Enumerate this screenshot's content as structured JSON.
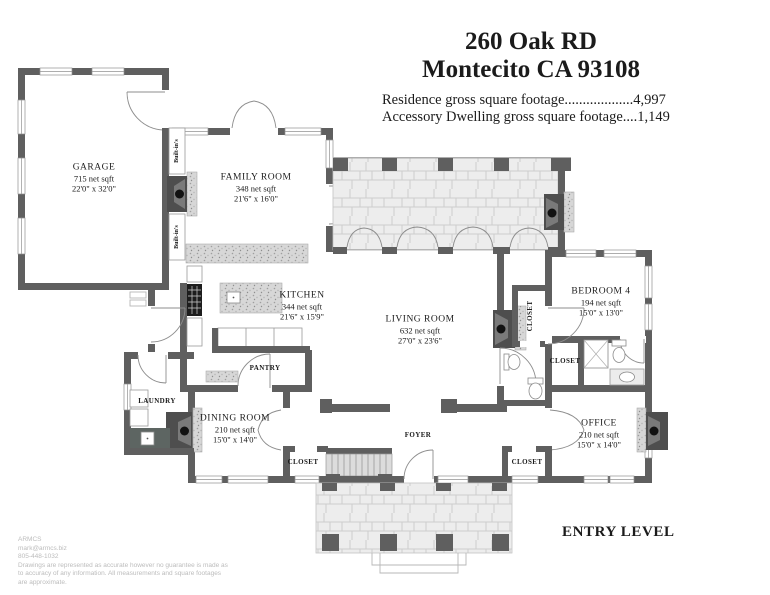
{
  "header": {
    "address_line1": "260 Oak RD",
    "address_line2": "Montecito CA 93108",
    "footage_line1": "Residence gross square footage...................4,997",
    "footage_line2": "Accessory Dwelling gross square footage....1,149"
  },
  "rooms": {
    "garage": {
      "name": "GARAGE",
      "sqft": "715 net sqft",
      "dims": "22'0\" x 32'0\""
    },
    "family_room": {
      "name": "FAMILY ROOM",
      "sqft": "348 net sqft",
      "dims": "21'6\" x 16'0\""
    },
    "kitchen": {
      "name": "KITCHEN",
      "sqft": "344 net sqft",
      "dims": "21'6\" x 15'9\""
    },
    "living_room": {
      "name": "LIVING ROOM",
      "sqft": "632 net sqft",
      "dims": "27'0\" x 23'6\""
    },
    "bedroom4": {
      "name": "BEDROOM 4",
      "sqft": "194 net sqft",
      "dims": "15'0\" x 13'0\""
    },
    "office": {
      "name": "OFFICE",
      "sqft": "210 net sqft",
      "dims": "15'0\" x 14'0\""
    },
    "dining_room": {
      "name": "DINING ROOM",
      "sqft": "210 net sqft",
      "dims": "15'0\" x 14'0\""
    }
  },
  "labels": {
    "foyer": "FOYER",
    "pantry": "PANTRY",
    "laundry": "LAUNDRY",
    "closet": "CLOSET",
    "built_ins": "Built-in's",
    "entry_level": "ENTRY LEVEL"
  },
  "footer": {
    "company": "ARMCS",
    "email": "mark@armcs.biz",
    "phone": "805-448-1032",
    "disclaimer": "Drawings are represented as accurate however no guarantee is made as to accuracy of any information. All measurements and square footages are approximate."
  },
  "colors": {
    "wall": "#5f5f5f",
    "stone": "#ededed",
    "label_text": "#1b1b1b",
    "footer_text": "#bcbcbc"
  }
}
